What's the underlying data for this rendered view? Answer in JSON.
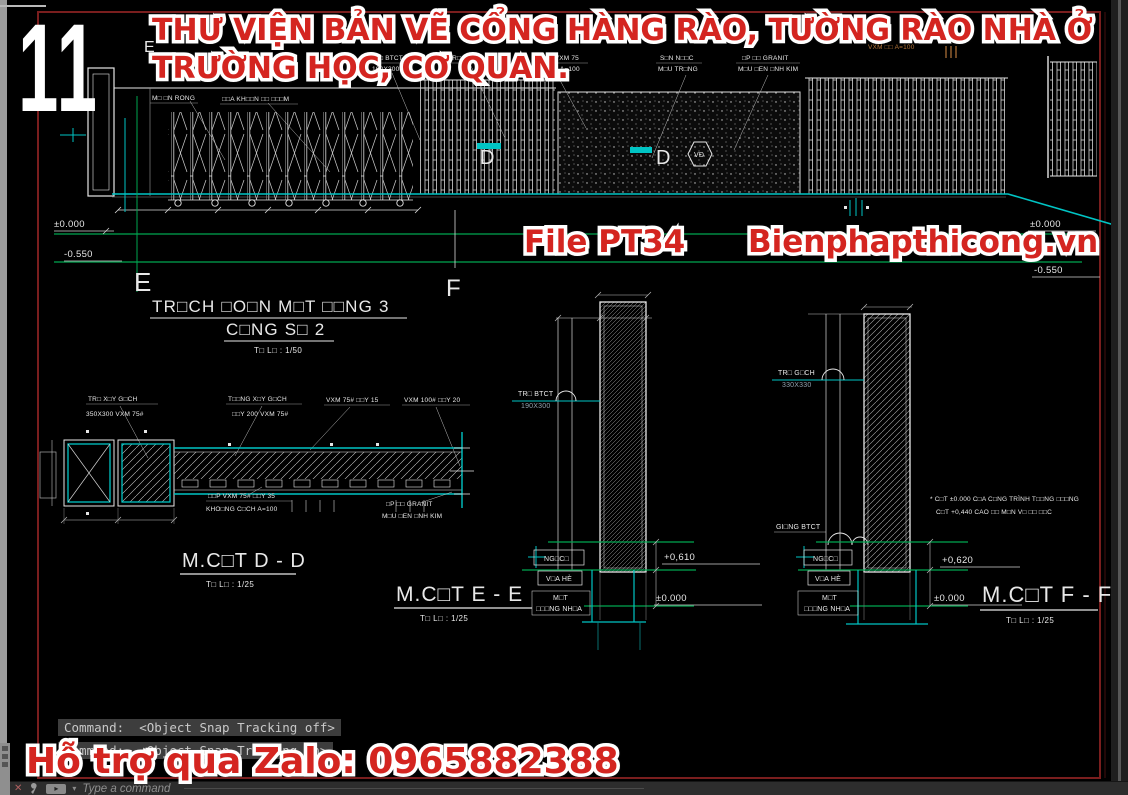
{
  "overlay": {
    "sheet_number": "11",
    "title_line1": "THƯ VIỆN BẢN VẼ CỔNG HÀNG RÀO, TƯỜNG RÀO NHÀ Ở",
    "title_line2": "TRƯỜNG HỌC, CƠ QUAN.",
    "file_label": "File PT34",
    "website": "Bienphapthicong.vn",
    "support_line": "Hỗ trợ qua Zalo: 0965882388",
    "text_color": "#d42520",
    "outline_color": "#ffffff"
  },
  "command_bar": {
    "line1": "Command:  <Object Snap Tracking off>",
    "line2": "Command:  <Object Snap Tracking on>",
    "prompt": "Type a command"
  },
  "drawing": {
    "colors": {
      "line": "#e8e8e8",
      "cyan": "#00c4c4",
      "green": "#00a651",
      "sheet_border_red": "#7a1e1e",
      "orange": "#b5763a"
    },
    "elevation": {
      "title": "TR□CH □O□N M□T □□NG 3",
      "subtitle": "C□NG S□ 2",
      "scale": "T□ L□ : 1/50",
      "marks": {
        "e_top": "E",
        "e_left": "E",
        "f": "F",
        "d1": "D",
        "d2": "D",
        "vd": "VĐ"
      },
      "levels": {
        "zero_left": "±0.000",
        "minus_left": "-0.550",
        "zero_right": "±0.000",
        "minus_right": "-0.550"
      },
      "callouts": [
        {
          "text": "M□ □N RONG"
        },
        {
          "text": "□□A KH□□N □□ □□□M"
        },
        {
          "text": "TR□ BTCT"
        },
        {
          "text": "190X300"
        },
        {
          "text": "TR□ G□CH"
        },
        {
          "text": "□□P VXM 75"
        },
        {
          "text": "□Y 35 A=100"
        },
        {
          "text": "S□N N□□C"
        },
        {
          "text": "M□U TR□NG"
        },
        {
          "text": "□P □□ GRANIT"
        },
        {
          "text": "M□U □EN □NH KIM"
        },
        {
          "text": "VXM □□ A=100"
        }
      ]
    },
    "section_dd": {
      "title": "M.C□T D - D",
      "scale": "T□ L□ : 1/25",
      "c1a": "TR□ X□Y G□CH",
      "c1b": "350X300 VXM 75#",
      "c2a": "T□□NG X□Y G□CH",
      "c2b": "□□Y 200 VXM 75#",
      "c3": "VXM 75# □□Y 15",
      "c4": "VXM 100# □□Y 20",
      "c5a": "□□P VXM 75# □□Y 35",
      "c5b": "KHO□NG C□CH A=100",
      "c6a": "□P □□ GRANIT",
      "c6b": "M□U □EN □NH KIM"
    },
    "section_ee": {
      "title": "M.C□T E - E",
      "scale": "T□ L□ : 1/25",
      "post_label1": "TR□ BTCT",
      "post_label2": "190X300",
      "ngach": "NG□C□",
      "viahe": "V□A HÈ",
      "mat1": "M□T",
      "mat2": "□□□NG NH□A",
      "level_top": "+0,610",
      "level_zero": "±0.000"
    },
    "section_ff": {
      "title": "M.C□T F - F",
      "scale": "T□ L□ : 1/25",
      "post_label1": "TR□ G□CH",
      "post_label2": "330X330",
      "giang": "GI□NG BTCT",
      "ngach": "NG□C□",
      "viahe": "V□A HÈ",
      "mat1": "M□T",
      "mat2": "□□□NG NH□A",
      "level_top": "+0,620",
      "level_zero": "±0.000",
      "note1": "* C□T ±0.000 C□A C□NG TRÌNH T□□NG □□□NG",
      "note2": "C□T +0,440 CAO □□ M□N V□ □□ □□C"
    }
  }
}
